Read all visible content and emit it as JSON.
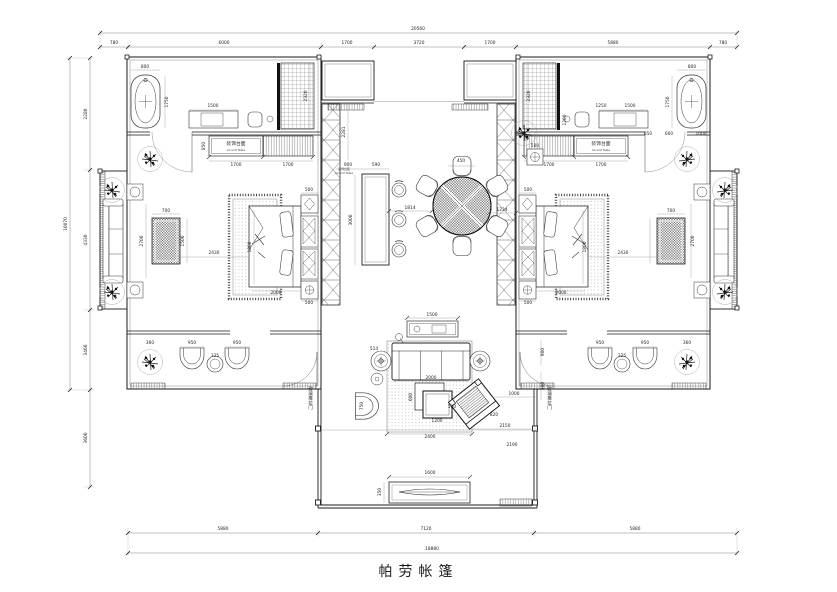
{
  "title_block": {
    "title": "帕劳帐篷"
  },
  "colors": {
    "line": "#1a1a1a",
    "muted": "#666666",
    "background": "#ffffff"
  },
  "dimensions": {
    "top_total": "20560",
    "top_segments": [
      "780",
      "6000",
      "1700",
      "3720",
      "1700",
      "5880",
      "780"
    ],
    "bottom_segments": [
      "5880",
      "7120",
      "5880"
    ],
    "bottom_total": "18880",
    "left_segments": [
      "2280",
      "4330",
      "3460",
      "3600"
    ],
    "left_total": "10070"
  },
  "labels": {
    "accent_table_cn": "装饰台面",
    "accent_table_en": "Accent Table",
    "sliding_door": "玻璃推拉门"
  },
  "annotations": [
    {
      "t": "20560",
      "x": 418,
      "y": 30,
      "c": "d"
    },
    {
      "t": "780",
      "x": 114,
      "y": 44,
      "c": "d"
    },
    {
      "t": "6000",
      "x": 224,
      "y": 44,
      "c": "d"
    },
    {
      "t": "1700",
      "x": 347,
      "y": 44,
      "c": "d"
    },
    {
      "t": "3720",
      "x": 419,
      "y": 44,
      "c": "d"
    },
    {
      "t": "1700",
      "x": 490,
      "y": 44,
      "c": "d"
    },
    {
      "t": "5880",
      "x": 613,
      "y": 44,
      "c": "d"
    },
    {
      "t": "780",
      "x": 723,
      "y": 44,
      "c": "d"
    },
    {
      "t": "5880",
      "x": 223,
      "y": 530,
      "c": "d"
    },
    {
      "t": "7120",
      "x": 426,
      "y": 530,
      "c": "d"
    },
    {
      "t": "5880",
      "x": 635,
      "y": 530,
      "c": "d"
    },
    {
      "t": "18880",
      "x": 432,
      "y": 550,
      "c": "d"
    },
    {
      "t": "10070",
      "x": 67,
      "y": 224,
      "c": "dv"
    },
    {
      "t": "2280",
      "x": 87,
      "y": 114,
      "c": "dv"
    },
    {
      "t": "4330",
      "x": 87,
      "y": 240,
      "c": "dv"
    },
    {
      "t": "3460",
      "x": 87,
      "y": 350,
      "c": "dv"
    },
    {
      "t": "3600",
      "x": 87,
      "y": 438,
      "c": "dv"
    },
    {
      "t": "800",
      "x": 145,
      "y": 68,
      "c": "d"
    },
    {
      "t": "1750",
      "x": 168,
      "y": 102,
      "c": "dv"
    },
    {
      "t": "1500",
      "x": 213,
      "y": 107,
      "c": "d"
    },
    {
      "t": "2320",
      "x": 307,
      "y": 96,
      "c": "dv"
    },
    {
      "t": "850",
      "x": 205,
      "y": 146,
      "c": "dv"
    },
    {
      "t": "1700",
      "x": 236,
      "y": 166,
      "c": "d"
    },
    {
      "t": "1700",
      "x": 288,
      "y": 166,
      "c": "d"
    },
    {
      "t": "装饰台面",
      "x": 236,
      "y": 145,
      "c": "cn"
    },
    {
      "t": "Accent Table",
      "x": 236,
      "y": 151,
      "c": "en"
    },
    {
      "t": "2700",
      "x": 143,
      "y": 241,
      "c": "dv"
    },
    {
      "t": "700",
      "x": 166,
      "y": 212,
      "c": "d"
    },
    {
      "t": "1500",
      "x": 184,
      "y": 241,
      "c": "dv"
    },
    {
      "t": "2430",
      "x": 214,
      "y": 254,
      "c": "d"
    },
    {
      "t": "1800",
      "x": 251,
      "y": 247,
      "c": "dv"
    },
    {
      "t": "2000",
      "x": 276,
      "y": 294,
      "c": "d"
    },
    {
      "t": "500",
      "x": 309,
      "y": 191,
      "c": "d"
    },
    {
      "t": "500",
      "x": 309,
      "y": 304,
      "c": "d"
    },
    {
      "t": "360",
      "x": 150,
      "y": 344,
      "c": "d"
    },
    {
      "t": "950",
      "x": 192,
      "y": 344,
      "c": "d"
    },
    {
      "t": "950",
      "x": 237,
      "y": 344,
      "c": "d"
    },
    {
      "t": "325",
      "x": 215,
      "y": 357,
      "c": "d"
    },
    {
      "t": "2281",
      "x": 345,
      "y": 132,
      "c": "dv"
    },
    {
      "t": "900",
      "x": 348,
      "y": 166,
      "c": "d"
    },
    {
      "t": "590",
      "x": 376,
      "y": 166,
      "c": "d"
    },
    {
      "t": "装饰台面",
      "x": 344,
      "y": 170,
      "c": "en"
    },
    {
      "t": "Accent Table",
      "x": 344,
      "y": 174,
      "c": "en"
    },
    {
      "t": "3000",
      "x": 352,
      "y": 220,
      "c": "dv"
    },
    {
      "t": "450",
      "x": 461,
      "y": 162,
      "c": "d"
    },
    {
      "t": "1814",
      "x": 410,
      "y": 209,
      "c": "d"
    },
    {
      "t": "1234",
      "x": 502,
      "y": 211,
      "c": "d"
    },
    {
      "t": "500",
      "x": 535,
      "y": 147,
      "c": "d"
    },
    {
      "t": "1500",
      "x": 432,
      "y": 316,
      "c": "d"
    },
    {
      "t": "514",
      "x": 374,
      "y": 350,
      "c": "d"
    },
    {
      "t": "2000",
      "x": 431,
      "y": 379,
      "c": "d"
    },
    {
      "t": "600",
      "x": 412,
      "y": 397,
      "c": "dv"
    },
    {
      "t": "500",
      "x": 452,
      "y": 408,
      "c": "d"
    },
    {
      "t": "1200",
      "x": 437,
      "y": 422,
      "c": "d"
    },
    {
      "t": "750",
      "x": 363,
      "y": 406,
      "c": "dv"
    },
    {
      "t": "1000",
      "x": 514,
      "y": 395,
      "c": "d"
    },
    {
      "t": "2150",
      "x": 505,
      "y": 427,
      "c": "d"
    },
    {
      "t": "2400",
      "x": 430,
      "y": 438,
      "c": "d"
    },
    {
      "t": "820",
      "x": 494,
      "y": 416,
      "c": "d"
    },
    {
      "t": "1600",
      "x": 430,
      "y": 474,
      "c": "d"
    },
    {
      "t": "350",
      "x": 381,
      "y": 492,
      "c": "dv"
    },
    {
      "t": "900",
      "x": 544,
      "y": 352,
      "c": "dv"
    },
    {
      "t": "500",
      "x": 544,
      "y": 386,
      "c": "dv"
    },
    {
      "t": "2190",
      "x": 512,
      "y": 446,
      "c": "d"
    },
    {
      "t": "玻璃推拉门",
      "x": 310,
      "y": 398,
      "c": "cnv"
    },
    {
      "t": "玻璃推拉门",
      "x": 549,
      "y": 398,
      "c": "cnv"
    },
    {
      "t": "800",
      "x": 692,
      "y": 68,
      "c": "d"
    },
    {
      "t": "1750",
      "x": 669,
      "y": 102,
      "c": "dv"
    },
    {
      "t": "1250",
      "x": 601,
      "y": 107,
      "c": "d"
    },
    {
      "t": "1500",
      "x": 630,
      "y": 107,
      "c": "d"
    },
    {
      "t": "2320",
      "x": 530,
      "y": 96,
      "c": "dv"
    },
    {
      "t": "1200",
      "x": 566,
      "y": 120,
      "c": "dv"
    },
    {
      "t": "650",
      "x": 648,
      "y": 135,
      "c": "d"
    },
    {
      "t": "600",
      "x": 669,
      "y": 135,
      "c": "d"
    },
    {
      "t": "1000",
      "x": 701,
      "y": 135,
      "c": "d"
    },
    {
      "t": "1700",
      "x": 549,
      "y": 166,
      "c": "d"
    },
    {
      "t": "1700",
      "x": 601,
      "y": 166,
      "c": "d"
    },
    {
      "t": "装饰台面",
      "x": 601,
      "y": 145,
      "c": "cn"
    },
    {
      "t": "Accent Table",
      "x": 601,
      "y": 151,
      "c": "en"
    },
    {
      "t": "500",
      "x": 528,
      "y": 191,
      "c": "d"
    },
    {
      "t": "500",
      "x": 528,
      "y": 304,
      "c": "d"
    },
    {
      "t": "1800",
      "x": 586,
      "y": 247,
      "c": "dv"
    },
    {
      "t": "2430",
      "x": 623,
      "y": 254,
      "c": "d"
    },
    {
      "t": "2000",
      "x": 561,
      "y": 294,
      "c": "d"
    },
    {
      "t": "700",
      "x": 671,
      "y": 212,
      "c": "d"
    },
    {
      "t": "2700",
      "x": 694,
      "y": 241,
      "c": "dv"
    },
    {
      "t": "950",
      "x": 600,
      "y": 344,
      "c": "d"
    },
    {
      "t": "950",
      "x": 645,
      "y": 344,
      "c": "d"
    },
    {
      "t": "325",
      "x": 622,
      "y": 357,
      "c": "d"
    },
    {
      "t": "360",
      "x": 687,
      "y": 344,
      "c": "d"
    }
  ]
}
